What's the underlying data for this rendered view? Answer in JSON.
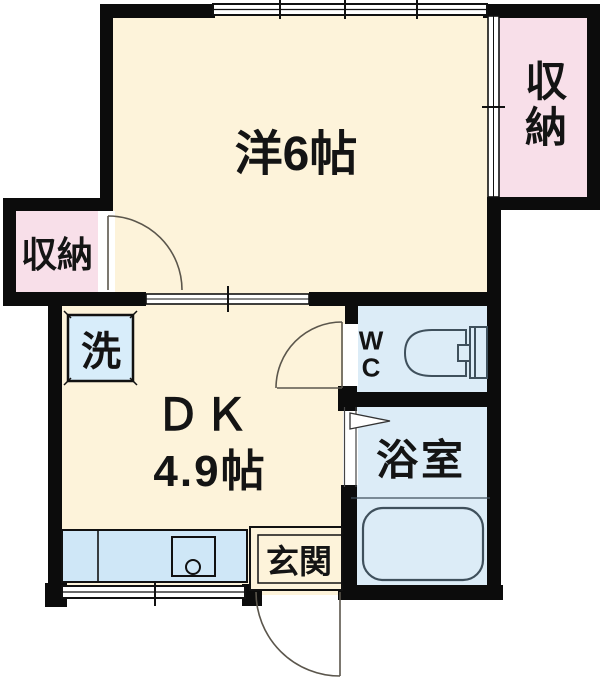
{
  "rooms": {
    "western_room": {
      "label": "洋6帖",
      "fill": "#fdf3da"
    },
    "dining_kitchen": {
      "label": "ＤＫ",
      "size": "4.9帖",
      "fill": "#fdf3da"
    },
    "closet_left": {
      "label": "収納",
      "fill": "#f8dfe9"
    },
    "closet_right": {
      "label": "収納",
      "fill": "#f8dfe9"
    },
    "wc": {
      "label_line1": "W",
      "label_line2": "C",
      "fill": "#dcecf7"
    },
    "bathroom": {
      "label": "浴室",
      "fill": "#dcecf7"
    },
    "entrance": {
      "label": "玄関",
      "fill": "#fdf3da"
    },
    "laundry": {
      "label": "洗",
      "fill": "#d8edfa"
    }
  },
  "fixtures": {
    "toilet": "toilet-symbol",
    "bathtub": "bathtub-symbol",
    "kitchen_counter": "kitchen-counter-with-sink",
    "washing_machine_pan": "washing-machine-space",
    "doors": [
      "hinged-door-closet",
      "hinged-door-wc",
      "folding-door-bath",
      "hinged-door-entrance"
    ],
    "windows": [
      "sliding-window-top",
      "sliding-window-bottom"
    ],
    "sliding_doors": [
      "room-divider-slider",
      "closet-right-slider"
    ]
  },
  "colors": {
    "wall": "#0c0c0c",
    "room_cream": "#fdf3da",
    "closet_pink": "#f8dfe9",
    "wet_area_blue": "#dcecf7",
    "counter_blue": "#cfe7f7",
    "fixture_line": "#3f505c",
    "door_arc": "#5b564c",
    "background": "#ffffff"
  }
}
